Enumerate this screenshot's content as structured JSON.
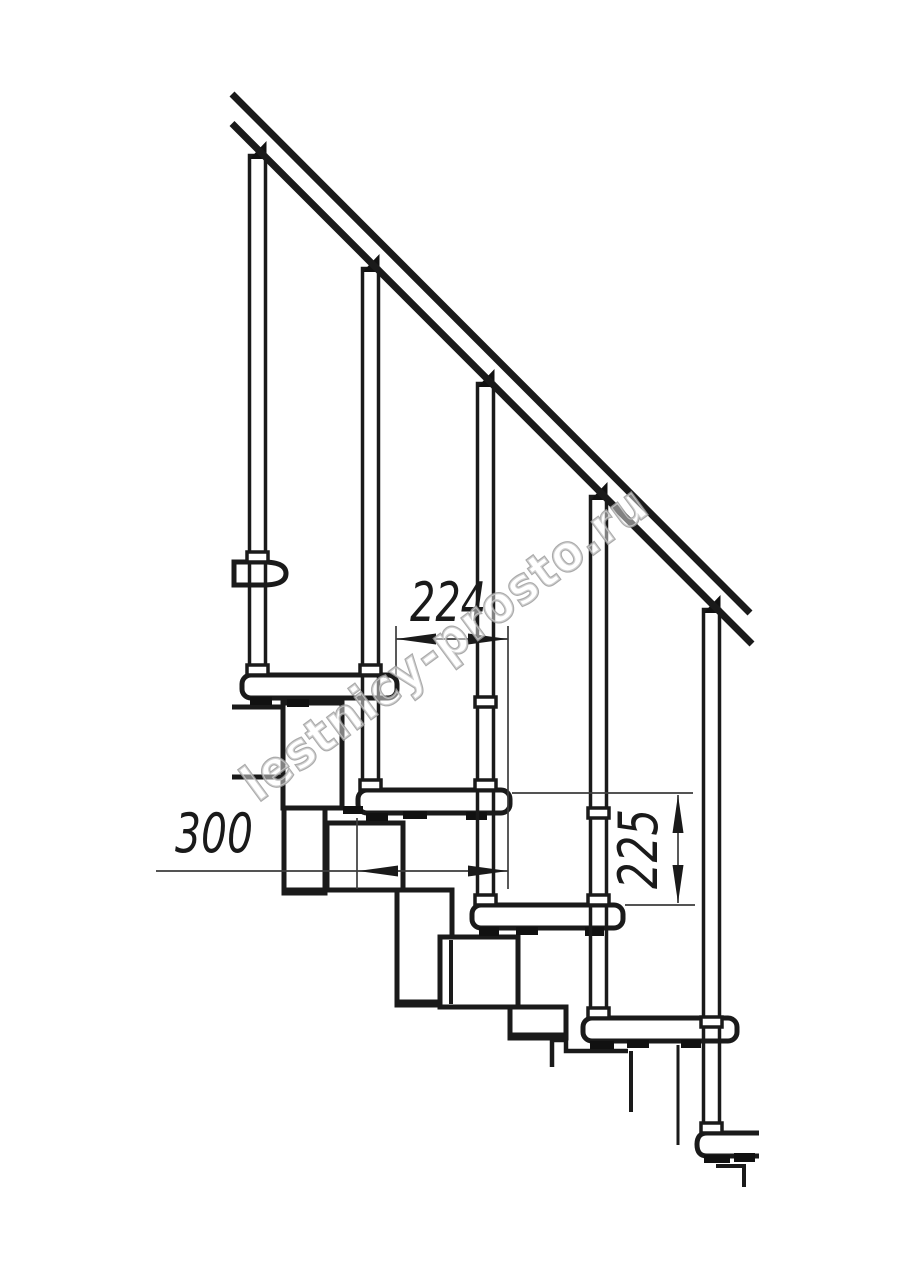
{
  "page": {
    "background_color": "#ffffff"
  },
  "drawing": {
    "kind": "modular-staircase-side-elevation",
    "line_color": "#1a1a1a",
    "dimension_line_color": "#3c3c3c",
    "watermark": {
      "text": "lestnicy-prosto.ru",
      "stroke_color": "#9b9b9b",
      "fill_color": "#ffffff"
    },
    "dimensions": {
      "step_going": {
        "value": "224",
        "orientation": "horizontal"
      },
      "tread_depth": {
        "value": "300",
        "orientation": "horizontal"
      },
      "step_rise": {
        "value": "225",
        "orientation": "vertical"
      }
    }
  }
}
